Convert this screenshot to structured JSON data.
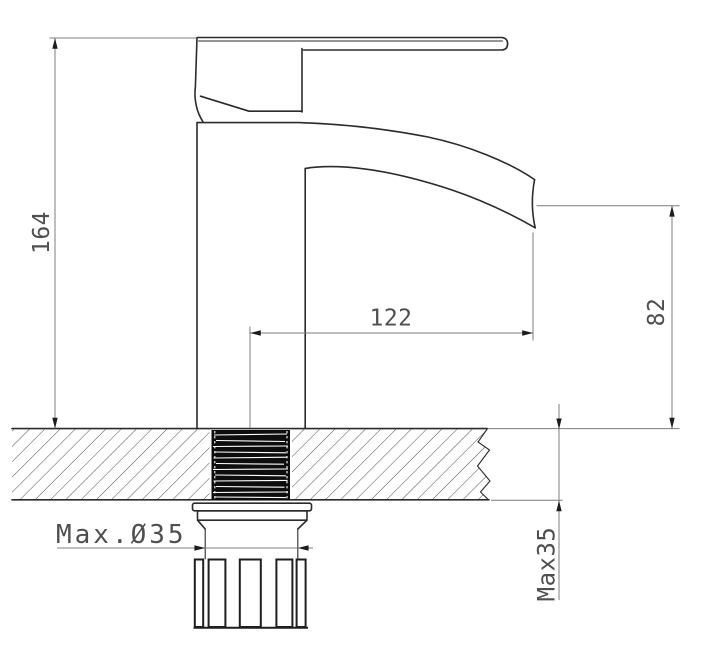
{
  "colors": {
    "background": "#ffffff",
    "object_line": "#2b2b2b",
    "dimension_line": "#7c7c7c",
    "arrow": "#1c1c1c",
    "text": "#4f4f4f",
    "thread_fill": "#0d0d0d"
  },
  "drawing": {
    "labels": {
      "overall_height": "164",
      "spout_reach": "122",
      "spout_outlet_height": "82",
      "max_deck_thickness": "Max35",
      "max_hole_diameter": "Max.Ø35"
    }
  }
}
